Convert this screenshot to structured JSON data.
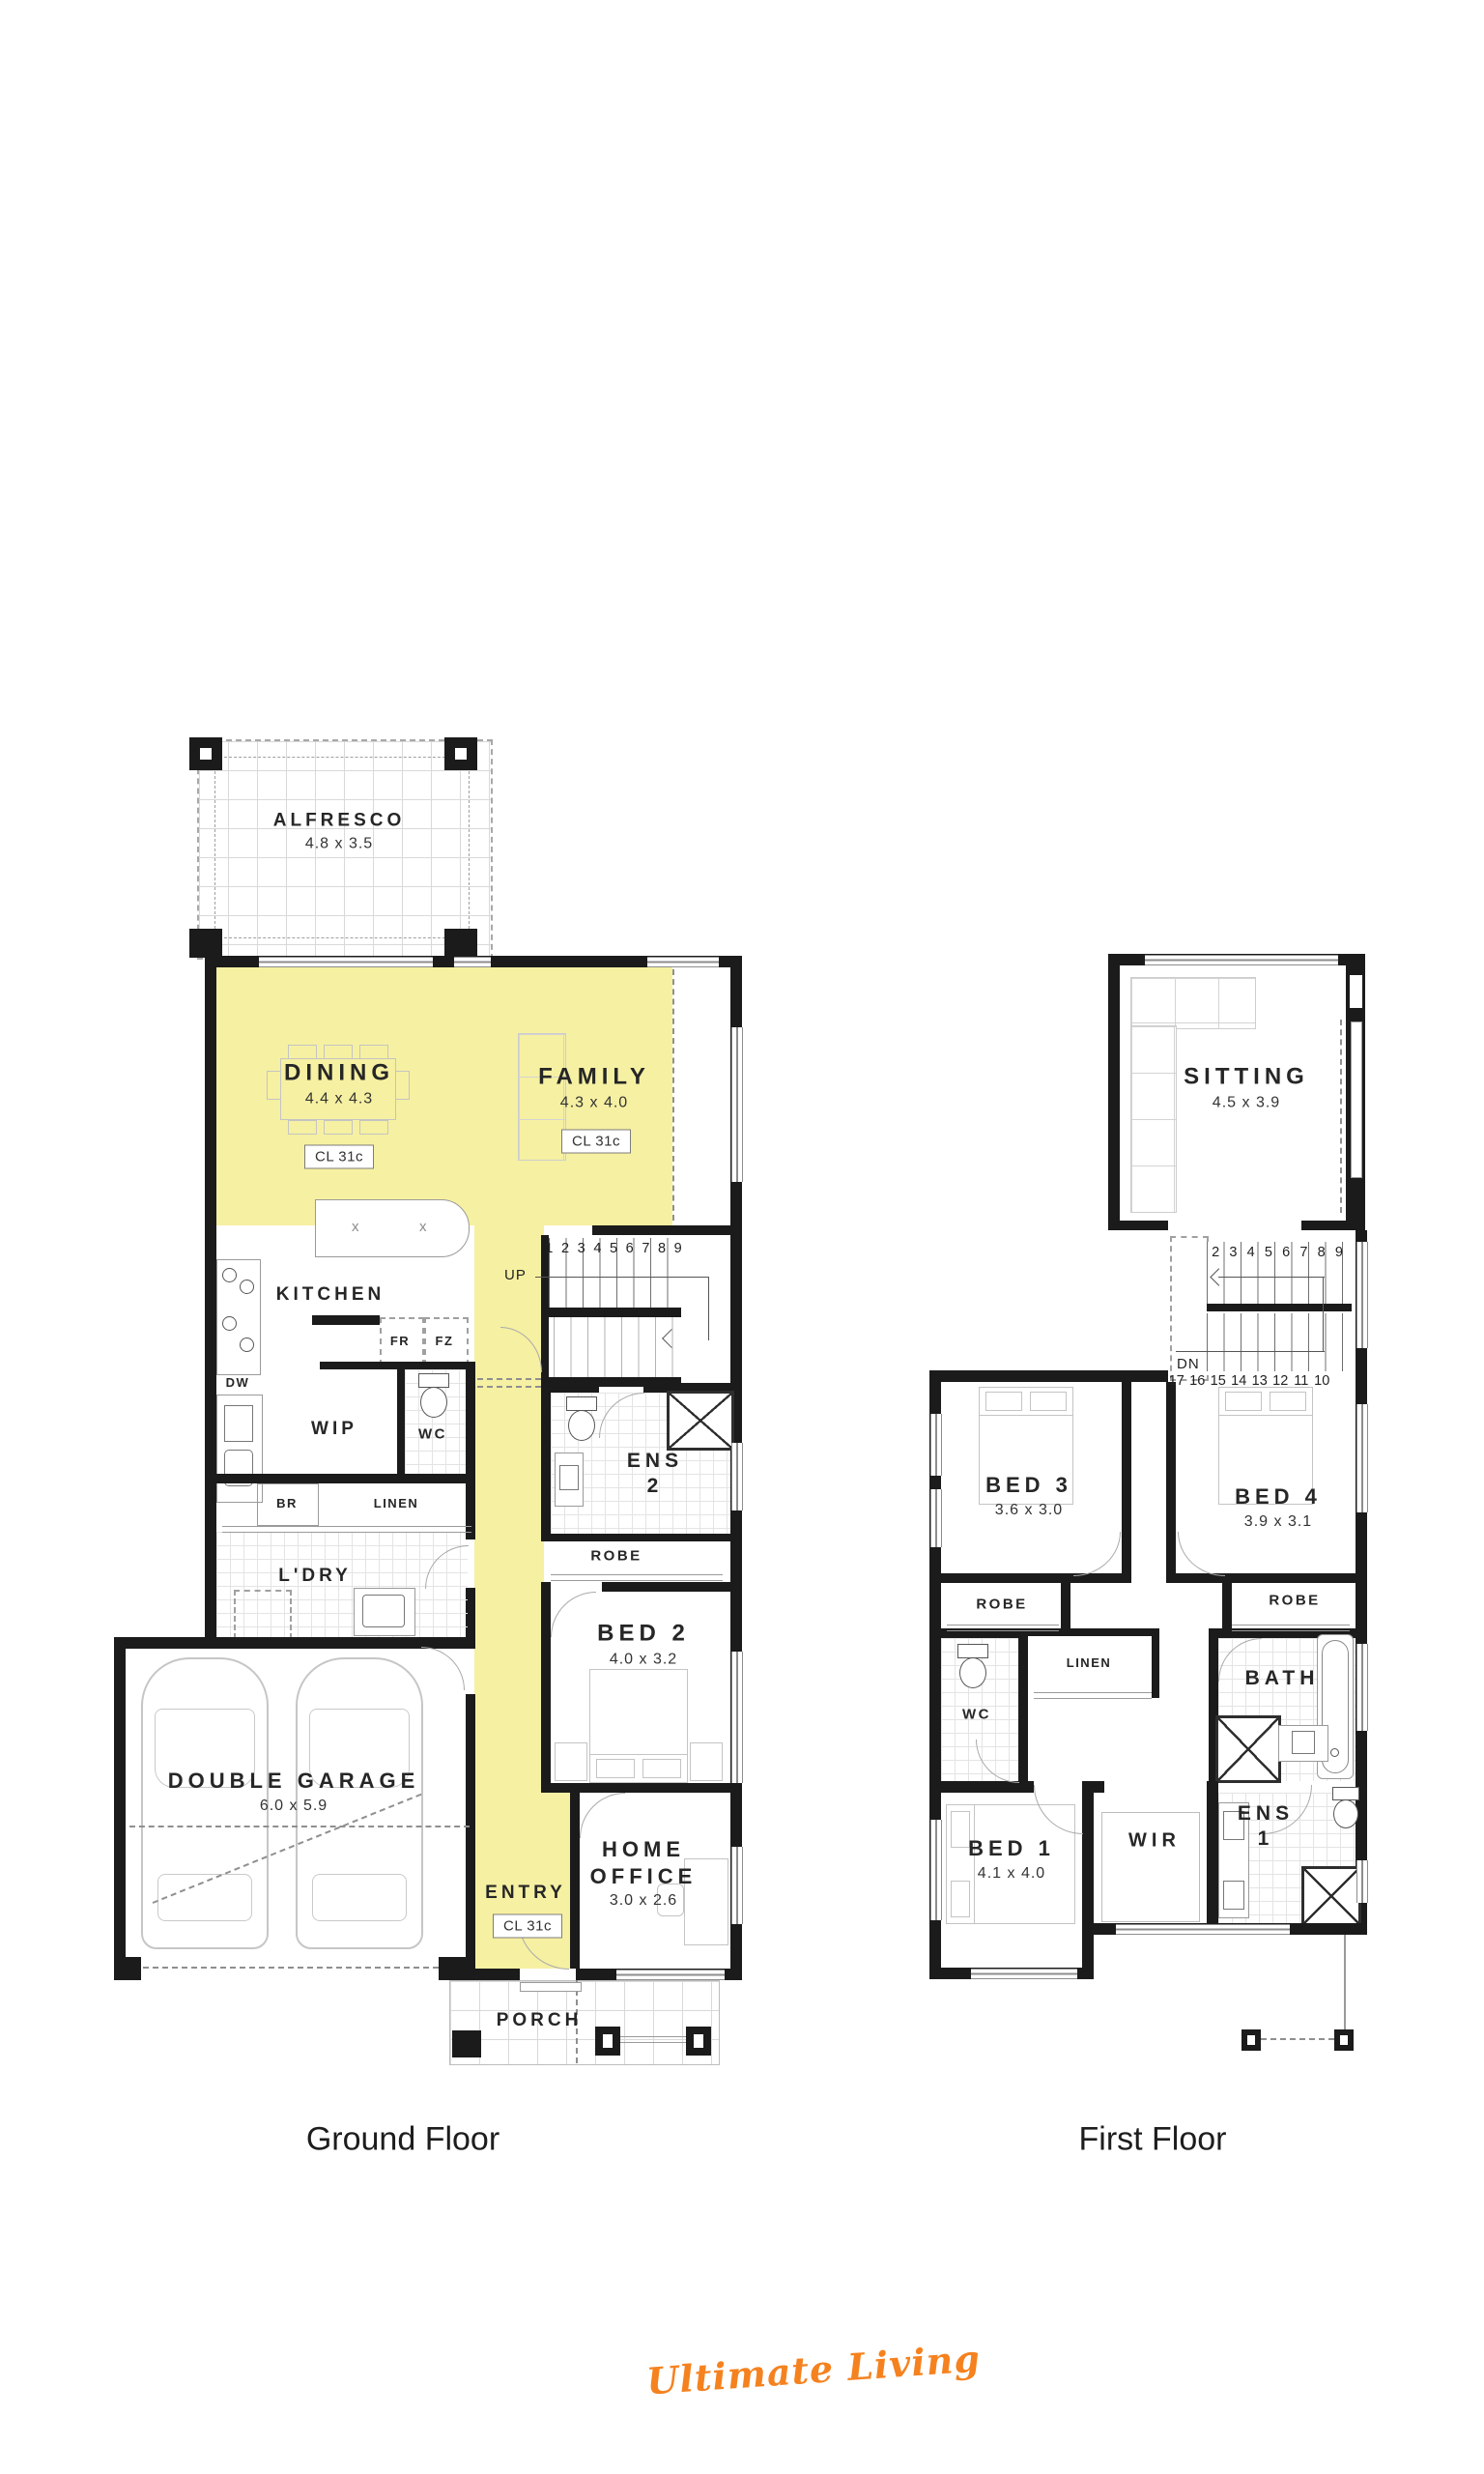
{
  "colors": {
    "highlight": "#F6F0A2",
    "wall": "#1B1B1B",
    "brand": "#F5821F"
  },
  "titles": {
    "ground": "Ground Floor",
    "first": "First Floor"
  },
  "brand": "Ultimate Living",
  "gf": {
    "alfresco": {
      "name": "ALFRESCO",
      "dim": "4.8 x 3.5"
    },
    "dining": {
      "name": "DINING",
      "dim": "4.4 x 4.3",
      "cl": "CL 31c"
    },
    "family": {
      "name": "FAMILY",
      "dim": "4.3 x 4.0",
      "cl": "CL 31c"
    },
    "kitchen": {
      "name": "KITCHEN"
    },
    "island_mark": "x",
    "dw": "DW",
    "fr": "FR",
    "fz": "FZ",
    "br": "BR",
    "wip": {
      "name": "WIP"
    },
    "wc": {
      "name": "WC"
    },
    "linen": {
      "name": "LINEN"
    },
    "ldry": {
      "name": "L'DRY"
    },
    "ens2": {
      "name": "ENS",
      "num": "2"
    },
    "robe": {
      "name": "ROBE"
    },
    "bed2": {
      "name": "BED 2",
      "dim": "4.0 x 3.2"
    },
    "garage": {
      "name": "DOUBLE GARAGE",
      "dim": "6.0 x 5.9"
    },
    "entry": {
      "name": "ENTRY",
      "cl": "CL 31c"
    },
    "office": {
      "name": "HOME OFFICE",
      "dim": "3.0 x 2.6"
    },
    "porch": {
      "name": "PORCH"
    },
    "stairs": {
      "dir": "UP",
      "numbers": [
        "1",
        "2",
        "3",
        "4",
        "5",
        "6",
        "7",
        "8",
        "9"
      ]
    }
  },
  "ff": {
    "sitting": {
      "name": "SITTING",
      "dim": "4.5 x 3.9"
    },
    "bed3": {
      "name": "BED 3",
      "dim": "3.6 x 3.0"
    },
    "bed4": {
      "name": "BED 4",
      "dim": "3.9 x 3.1"
    },
    "robe3": "ROBE",
    "robe4": "ROBE",
    "wc": {
      "name": "WC"
    },
    "linen": {
      "name": "LINEN"
    },
    "bath": {
      "name": "BATH"
    },
    "bed1": {
      "name": "BED 1",
      "dim": "4.1 x 4.0"
    },
    "wir": {
      "name": "WIR"
    },
    "ens1": {
      "name": "ENS",
      "num": "1"
    },
    "stairs": {
      "dir": "DN",
      "top": [
        "2",
        "3",
        "4",
        "5",
        "6",
        "7",
        "8",
        "9"
      ],
      "bottom": [
        "17",
        "16",
        "15",
        "14",
        "13",
        "12",
        "11",
        "10"
      ]
    }
  }
}
